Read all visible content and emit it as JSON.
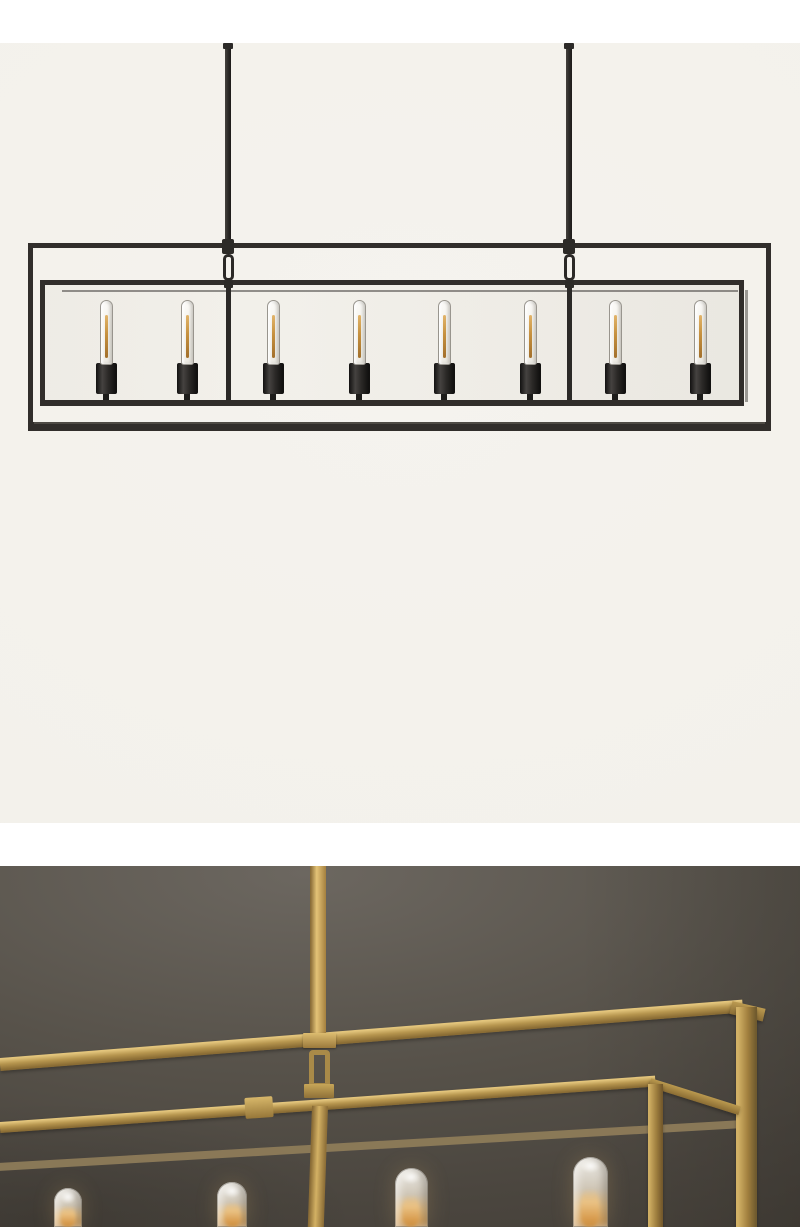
{
  "meta": {
    "description": "Product photo gallery: linear box-frame chandelier shown twice — blackened-steel full view on cream background, and aged-brass close-up detail against a dark charcoal wall",
    "canvas_width": 800,
    "canvas_height": 1227
  },
  "palette": {
    "page_background": "#ffffff",
    "top_photo_background": "#f5f3ee",
    "frame_black": "#312e2b",
    "socket_black": "#1e1c1b",
    "filament_amber": "#c6913f",
    "wall_light": "#6c6760",
    "wall_mid": "#57524a",
    "wall_dark": "#433e37",
    "brass_highlight": "#e3c57c",
    "brass_mid": "#b6954e",
    "brass_shadow": "#8a6c34",
    "bulb_glow": "#e2b475"
  },
  "gallery": {
    "top_photo": {
      "alt": "Linear rectangular open double-frame chandelier in blackened bronze with two ceiling rods and eight exposed tubular filament bulbs, front view on cream background",
      "bulb_count": 8,
      "bulb_centers_x": [
        106,
        187,
        273,
        359,
        444,
        530,
        615,
        700
      ],
      "rod_centers_x": [
        228,
        569
      ]
    },
    "bottom_photo": {
      "alt": "Close-up angled detail of the same chandelier in aged brass hanging from a rod against a dark charcoal wall, four lit frosted tubular bulbs glowing below the double frame",
      "bulb_count": 4,
      "bulbs": [
        {
          "cx": 68,
          "width": 28,
          "top": 322
        },
        {
          "cx": 232,
          "width": 30,
          "top": 316
        },
        {
          "cx": 411,
          "width": 33,
          "top": 302
        },
        {
          "cx": 590,
          "width": 35,
          "top": 291
        }
      ]
    }
  }
}
